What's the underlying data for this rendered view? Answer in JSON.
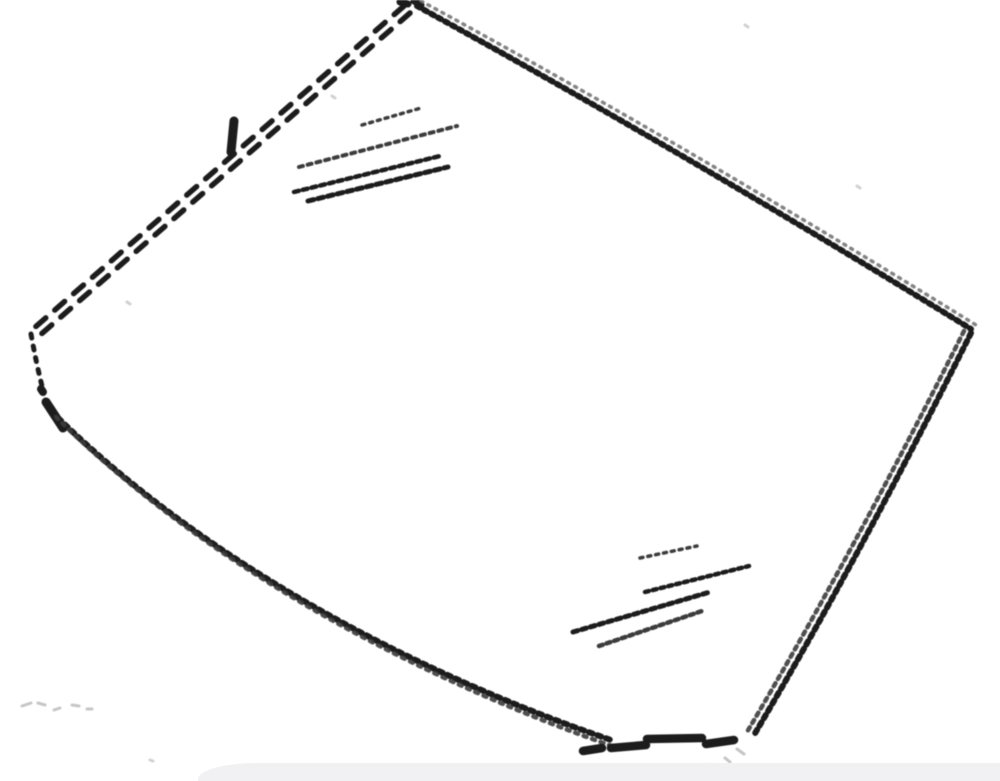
{
  "scene": {
    "description": "pencil-sketch line drawing of a curved windshield glass panel drawn with dashed and dotted strokes, glare hatch marks in the upper-left and lower-right of the glass, and the top sliver of a light gray rounded panel at the bottom edge of the page",
    "background": "#ffffff",
    "canvas": {
      "width": 1000,
      "height": 781
    },
    "viewbox": "0 0 1000 781"
  },
  "palette": {
    "ink": "#1c1c1c",
    "ink2": "#3c3c3c",
    "soft": "#6e6e6e",
    "speck": "#c6c6ca",
    "speck_dark": "#9c9c9c",
    "panel": "#f1f1f3"
  },
  "sketch": {
    "paths": [
      {
        "name": "top-left-edge-outer-dashed",
        "d": "M404 6 L33 329",
        "w": 5.5,
        "dash": "13 12",
        "color": "ink"
      },
      {
        "name": "top-left-edge-inner-dashed",
        "d": "M410 13 L39 336",
        "w": 5.5,
        "dash": "13 12",
        "color": "ink"
      },
      {
        "name": "top-left-tick-mark",
        "d": "M234 121 L231 152",
        "w": 9,
        "dash": "",
        "color": "ink",
        "cap": "butt"
      },
      {
        "name": "apex-marks",
        "d": "M400 2 l8 2 M414 1 l7 4",
        "w": 7,
        "dash": "",
        "color": "ink"
      },
      {
        "name": "top-right-edge-beaded",
        "d": "M417 6 Q680 150 971 329",
        "w": 6,
        "dash": "3.5 4.5",
        "color": "ink"
      },
      {
        "name": "top-right-edge-echo",
        "d": "M421 1 Q684 144 976 325",
        "w": 3.5,
        "dash": "2 6",
        "color": "soft",
        "opacity": 0.85
      },
      {
        "name": "right-edge-beaded",
        "d": "M971 333 Q860 556 754 735",
        "w": 6,
        "dash": "4 4.5",
        "color": "ink"
      },
      {
        "name": "right-edge-echo",
        "d": "M964 331 Q853 553 747 732",
        "w": 4.5,
        "dash": "3.5 5",
        "color": "ink2",
        "opacity": 0.9
      },
      {
        "name": "left-corner-curve",
        "d": "M31 334 Q36 362 42 386",
        "w": 5,
        "dash": "4 8",
        "color": "ink"
      },
      {
        "name": "left-corner-dot",
        "d": "M41 389 l2 3",
        "w": 8,
        "dash": "",
        "color": "ink"
      },
      {
        "name": "bottom-left-corner-stroke",
        "d": "M46 402 L63 428",
        "w": 9,
        "dash": "",
        "color": "ink"
      },
      {
        "name": "bottom-edge-beaded",
        "d": "M52 412 C184 543 382 662 614 741",
        "w": 6,
        "dash": "4 5",
        "color": "ink"
      },
      {
        "name": "bottom-edge-echo",
        "d": "M56 417 C188 548 386 667 612 746",
        "w": 4.5,
        "dash": "3 6",
        "color": "ink2",
        "opacity": 0.9
      },
      {
        "name": "bottom-corner-bold-dashes",
        "d": "M583 751 l19 -3 M611 748 l35 -3 M647 739 l55 -1 M706 744 l28 -4",
        "w": 8.5,
        "dash": "",
        "color": "ink",
        "cap": "butt"
      },
      {
        "name": "upper-glare-stroke-1",
        "d": "M362 125 L421 108",
        "w": 3.5,
        "dash": "3 5",
        "color": "ink2"
      },
      {
        "name": "upper-glare-stroke-2",
        "d": "M299 167 L457 126",
        "w": 4,
        "dash": "4 5",
        "color": "ink2"
      },
      {
        "name": "upper-glare-stroke-3",
        "d": "M294 192 L440 156",
        "w": 4.5,
        "dash": "5 4",
        "color": "ink"
      },
      {
        "name": "upper-glare-stroke-4",
        "d": "M308 201 L448 167",
        "w": 5,
        "dash": "6 4",
        "color": "ink"
      },
      {
        "name": "lower-glare-stroke-1",
        "d": "M640 558 L697 546",
        "w": 3.5,
        "dash": "3 5",
        "color": "ink2"
      },
      {
        "name": "lower-glare-stroke-2",
        "d": "M645 592 L749 566",
        "w": 4.5,
        "dash": "4 4",
        "color": "ink"
      },
      {
        "name": "lower-glare-stroke-3",
        "d": "M573 632 L710 592",
        "w": 5,
        "dash": "5 4",
        "color": "ink"
      },
      {
        "name": "lower-glare-stroke-4",
        "d": "M599 646 L705 610",
        "w": 4.5,
        "dash": "4 4",
        "color": "ink2"
      },
      {
        "name": "corner-speckles",
        "d": "M737 749 l7 5 M725 758 l5 4 M710 765 l5 3",
        "w": 3,
        "dash": "",
        "color": "speck_dark",
        "opacity": 0.6
      },
      {
        "name": "bottom-left-faint-marks",
        "d": "M22 706 l9 -3 M38 703 l7 2 M54 710 l6 -2 M72 705 l7 1 M87 709 l5 0",
        "w": 3,
        "dash": "",
        "color": "speck"
      },
      {
        "name": "paper-noise-dots",
        "d": "M745 25 l3 2 M857 186 l3 2 M332 96 l3 2 M127 302 l3 2 M150 760 l3 1",
        "w": 3,
        "dash": "",
        "color": "speck",
        "opacity": 0.8
      }
    ]
  },
  "bottom_panel": {
    "left": 198,
    "top": 763,
    "height": 18,
    "radius_x": 60,
    "radius_y": 16,
    "color_key": "panel"
  }
}
